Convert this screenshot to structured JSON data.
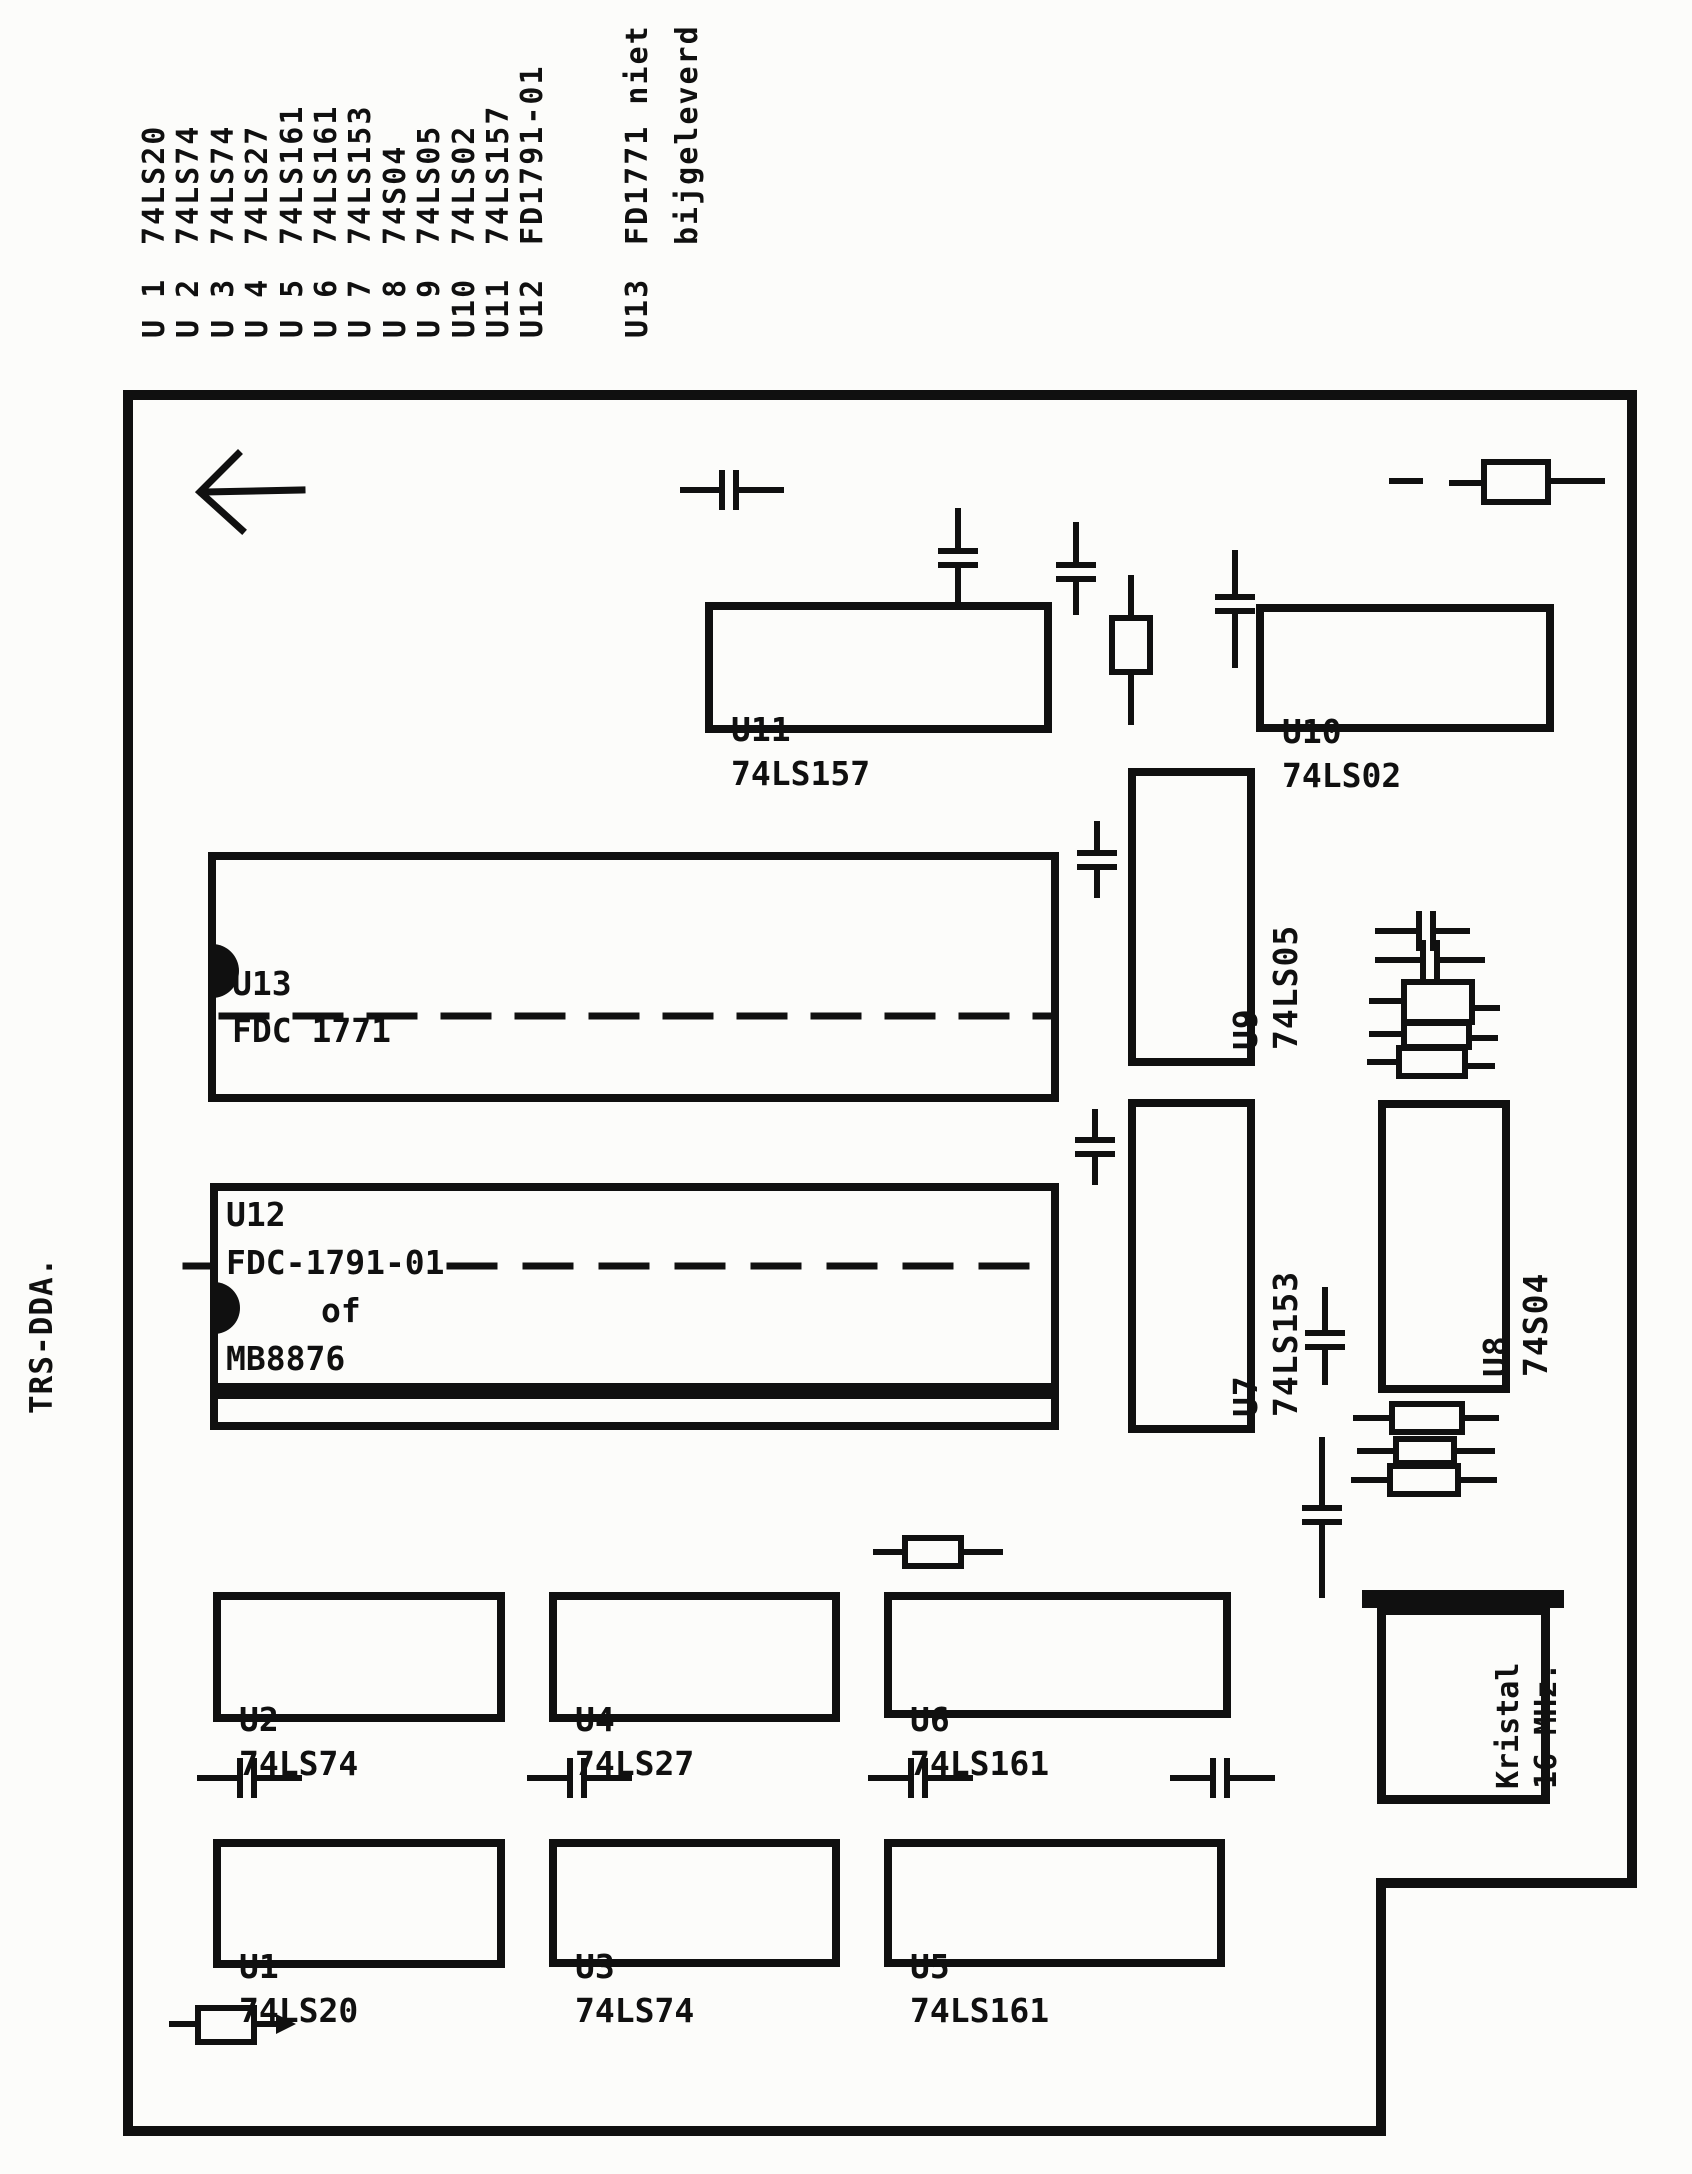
{
  "document": {
    "side_label": "TRS-DDA."
  },
  "legend": {
    "items": [
      {
        "ref": "U 1",
        "part": "74LS20"
      },
      {
        "ref": "U 2",
        "part": "74LS74"
      },
      {
        "ref": "U 3",
        "part": "74LS74"
      },
      {
        "ref": "U 4",
        "part": "74LS27"
      },
      {
        "ref": "U 5",
        "part": "74LS161"
      },
      {
        "ref": "U 6",
        "part": "74LS161"
      },
      {
        "ref": "U 7",
        "part": "74LS153"
      },
      {
        "ref": "U 8",
        "part": "74S04"
      },
      {
        "ref": "U 9",
        "part": "74LS05"
      },
      {
        "ref": "U10",
        "part": "74LS02"
      },
      {
        "ref": "U11",
        "part": "74LS157"
      },
      {
        "ref": "U12",
        "part": "FD1791-01"
      },
      {
        "ref": "U13",
        "part": "FD1771 niet"
      },
      {
        "ref": "",
        "part": "bijgeleverd"
      }
    ]
  },
  "board": {
    "chips": {
      "u1": {
        "ref": "U1",
        "part": "74LS20"
      },
      "u2": {
        "ref": "U2",
        "part": "74LS74"
      },
      "u3": {
        "ref": "U3",
        "part": "74LS74"
      },
      "u4": {
        "ref": "U4",
        "part": "74LS27"
      },
      "u5": {
        "ref": "U5",
        "part": "74LS161"
      },
      "u6": {
        "ref": "U6",
        "part": "74LS161"
      },
      "u7": {
        "ref": "U7",
        "part": "74LS153"
      },
      "u8": {
        "ref": "U8",
        "part": "74S04"
      },
      "u9": {
        "ref": "U9",
        "part": "74LS05"
      },
      "u10": {
        "ref": "U10",
        "part": "74LS02"
      },
      "u11": {
        "ref": "U11",
        "part": "74LS157"
      },
      "u12": {
        "ref": "U12",
        "line2": "FDC-1791-01",
        "line3": "of",
        "line4": "MB8876"
      },
      "u13": {
        "ref": "U13",
        "part": "FDC 1771"
      },
      "crystal": {
        "line1": "Kristal",
        "line2": "16 MHz."
      }
    }
  },
  "colors": {
    "ink": "#101010",
    "paper": "#fcfcfa"
  }
}
